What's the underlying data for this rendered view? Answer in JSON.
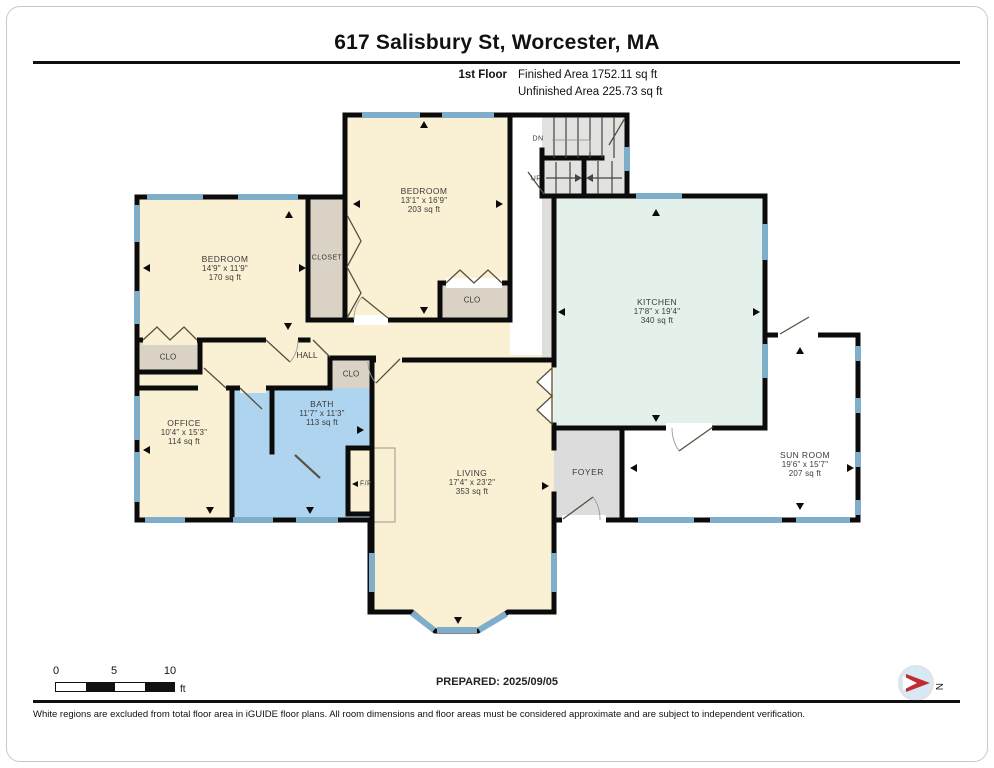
{
  "header": {
    "title": "617 Salisbury St, Worcester, MA",
    "floor_label": "1st Floor",
    "finished": "Finished Area 1752.11 sq ft",
    "unfinished": "Unfinished Area 225.73 sq ft"
  },
  "rooms": {
    "bedroom_left": {
      "name": "BEDROOM",
      "dims": "14'9\" x 11'9\"",
      "area": "170 sq ft"
    },
    "bedroom_top": {
      "name": "BEDROOM",
      "dims": "13'1\" x 16'9\"",
      "area": "203 sq ft"
    },
    "kitchen": {
      "name": "KITCHEN",
      "dims": "17'8\" x 19'4\"",
      "area": "340 sq ft"
    },
    "office": {
      "name": "OFFICE",
      "dims": "10'4\" x 15'3\"",
      "area": "114 sq ft"
    },
    "bath": {
      "name": "BATH",
      "dims": "11'7\" x 11'3\"",
      "area": "113 sq ft"
    },
    "living": {
      "name": "LIVING",
      "dims": "17'4\" x 23'2\"",
      "area": "353 sq ft"
    },
    "sunroom": {
      "name": "SUN ROOM",
      "dims": "19'6\" x 15'7\"",
      "area": "207 sq ft"
    }
  },
  "small_labels": {
    "closet": "CLOSET",
    "clo": "CLO",
    "hall": "HALL",
    "foyer": "FOYER",
    "fireplace": "F/P",
    "down": "DN",
    "up": "UP"
  },
  "compass": {
    "north": "N"
  },
  "scale_bar": {
    "tick0": "0",
    "tick5": "5",
    "tick10": "10",
    "unit": "ft"
  },
  "prepared": "PREPARED: 2025/09/05",
  "disclaimer": "White regions are excluded from total floor area in iGUIDE floor plans. All room dimensions and floor areas must be considered approximate and are subject to independent verification.",
  "colors": {
    "room_fill": "#FAF0D3",
    "kitchen_fill": "#E4F1EA",
    "bath_fill": "#AED4F0",
    "closet_fill": "#D9D2C5",
    "stairs_fill": "#E2E2E0",
    "foyer_fill": "#DCDCDC",
    "window_blue": "#7FAECB",
    "wall_black": "#0B0B0B",
    "compass_red": "#C22B33"
  }
}
